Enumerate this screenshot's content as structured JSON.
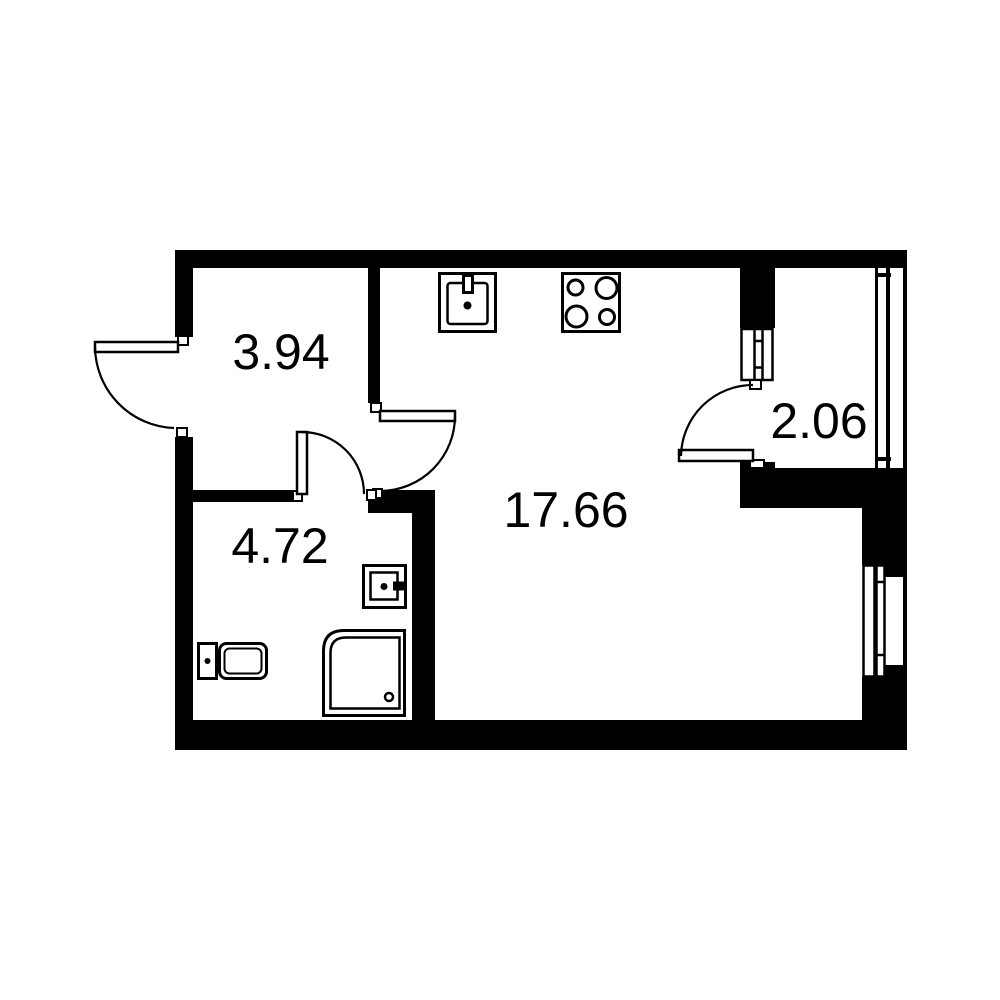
{
  "plan": {
    "type": "apartment-floor-plan",
    "background_color": "#ffffff",
    "wall_color": "#000000",
    "line_color": "#000000",
    "rooms": [
      {
        "id": "hallway",
        "area_label": "3.94"
      },
      {
        "id": "living-kitchen",
        "area_label": "17.66"
      },
      {
        "id": "bathroom",
        "area_label": "4.72"
      },
      {
        "id": "balcony",
        "area_label": "2.06"
      }
    ],
    "fixtures": [
      {
        "id": "kitchen-sink"
      },
      {
        "id": "stove-4-burner"
      },
      {
        "id": "bathroom-sink"
      },
      {
        "id": "toilet"
      },
      {
        "id": "shower-cabin"
      }
    ],
    "doors": [
      {
        "id": "entrance-door"
      },
      {
        "id": "living-room-door"
      },
      {
        "id": "bathroom-door"
      },
      {
        "id": "balcony-door"
      }
    ],
    "windows": [
      {
        "id": "living-room-window"
      },
      {
        "id": "balcony-glazing"
      },
      {
        "id": "balcony-partition-window"
      }
    ]
  }
}
